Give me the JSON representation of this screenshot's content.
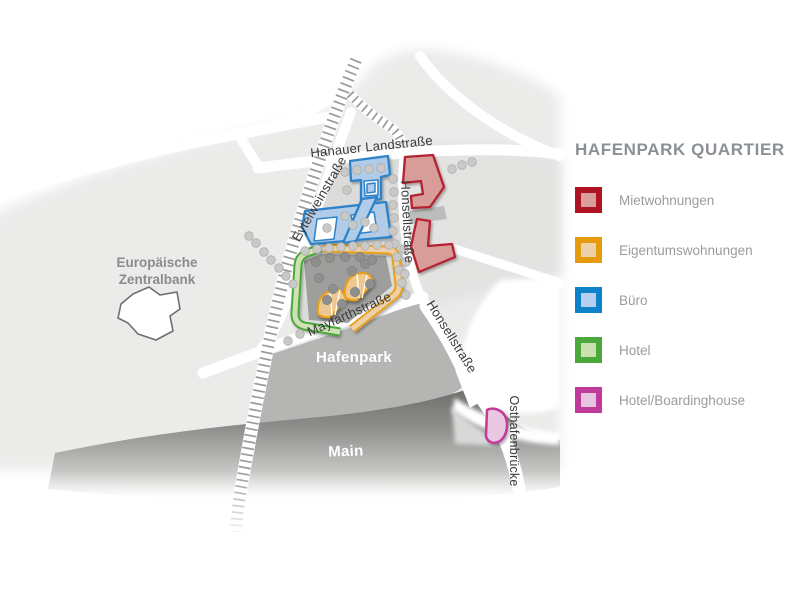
{
  "legend": {
    "title": "HAFENPARK QUARTIER",
    "items": [
      {
        "label": "Mietwohnungen",
        "border": "#b01323",
        "fill": "#d9a09b"
      },
      {
        "label": "Eigentumswohnungen",
        "border": "#e59c0c",
        "fill": "#ecd0a9"
      },
      {
        "label": "Büro",
        "border": "#0e82c8",
        "fill": "#b5cfee"
      },
      {
        "label": "Hotel",
        "border": "#4ba83a",
        "fill": "#cbe0af"
      },
      {
        "label": "Hotel/Boardinghouse",
        "border": "#c03a98",
        "fill": "#e6c3e0"
      }
    ]
  },
  "map": {
    "streets": {
      "hanauer_landstrasse": "Hanauer Landstraße",
      "eytelweinstrasse": "Eytelweinstraße",
      "honsellstrasse": "Honsellstraße",
      "mayfarthstrasse": "Mayfarthstraße",
      "osthafenbruecke": "Osthafenbrücke"
    },
    "areas": {
      "hafenpark": "Hafenpark",
      "main_river": "Main",
      "ecb_line1": "Europäische",
      "ecb_line2": "Zentralbank"
    }
  }
}
